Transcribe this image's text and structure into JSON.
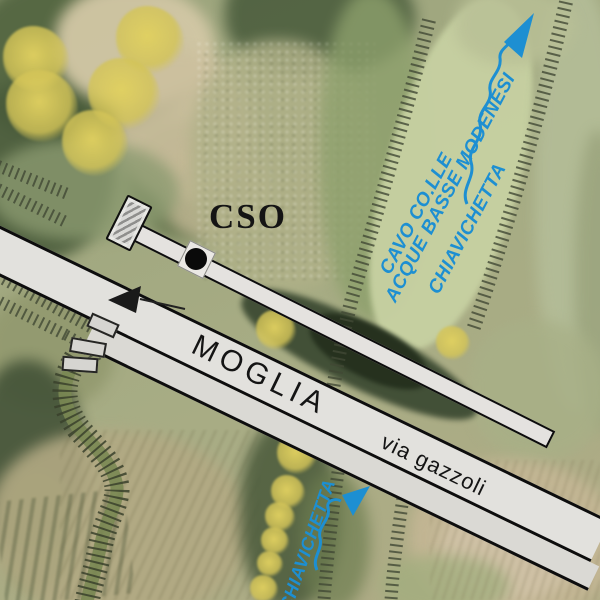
{
  "annotations": {
    "cso_label": "CSO",
    "road_label": "MOGLIA",
    "street_label": "via gazzoli",
    "canal_label_line1": "CAVO CO.LLE",
    "canal_label_line2": "ACQUE BASSE MODENESI",
    "canal_gate_label_right": "CHIAVICHETTA",
    "canal_gate_label_bottom": "CHIAVICHETTA"
  },
  "colors": {
    "annotation_blue": "#1d8fd2",
    "tree_yellow": "#d9c85e",
    "road_fill": "#e2e1dd",
    "conduit_fill": "#e4e2df",
    "outline_black": "#0d0d0d",
    "hatch_tick": "#414834",
    "road_arrow_black": "#1a1a1a"
  },
  "symbols": {
    "flow_arrow_top": "flow-direction-arrow",
    "flow_arrow_bottom": "flow-direction-arrow",
    "road_direction_arrow": "road-direction-arrow",
    "sluice_gate": "sluice-gate-symbol",
    "cso_node": "cso-node-dot",
    "tree": "tree-canopy-symbol",
    "embankment": "embankment-hatching"
  }
}
